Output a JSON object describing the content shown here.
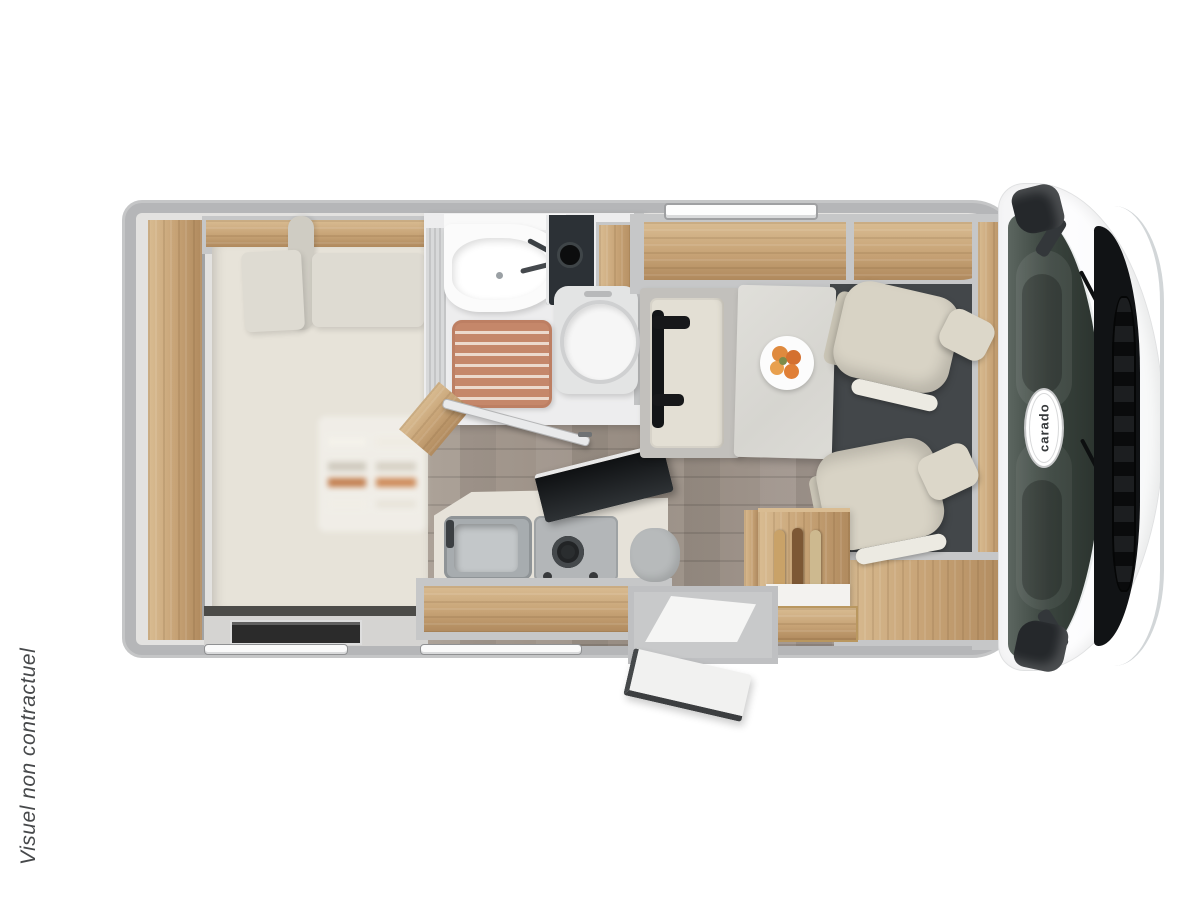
{
  "caption": {
    "text": "Visuel non contractuel"
  },
  "cab": {
    "logo_text": "carado"
  },
  "floorplan": {
    "type": "motorhome-top-view-floor-plan",
    "areas": [
      "rear-french-bed",
      "wardrobe",
      "overhead-locker",
      "bathroom",
      "washbasin",
      "toilet",
      "shower-wood-mat",
      "kitchen-sink",
      "gas-hob",
      "glass-lid",
      "dinette-bench",
      "dinette-table",
      "fruit-plate",
      "swivel-cab-seat-front",
      "swivel-cab-seat-rear",
      "bottle-cabinet",
      "entrance-step",
      "entrance-door-open",
      "driver-cab",
      "windshield",
      "grille",
      "side-mirror",
      "windows"
    ]
  },
  "palette": {
    "bg": "#ffffff",
    "wall": "#b5b6b8",
    "wall_light": "#d2d3d4",
    "wood": "#c7a376",
    "wood_dark": "#b08a5e",
    "wood_light": "#d9bc92",
    "bed": "#e7e3d9",
    "pillow": "#dedbd2",
    "seat": "#d8d3c5",
    "floor_wood": "#a79c92",
    "bath": "#ededee",
    "cab_mat": "#43474a",
    "glass": "#39433d",
    "black_trim": "#131517",
    "accent_mat": "#c5876a",
    "fruit": "#df8a3e",
    "caption": "#47494b"
  }
}
